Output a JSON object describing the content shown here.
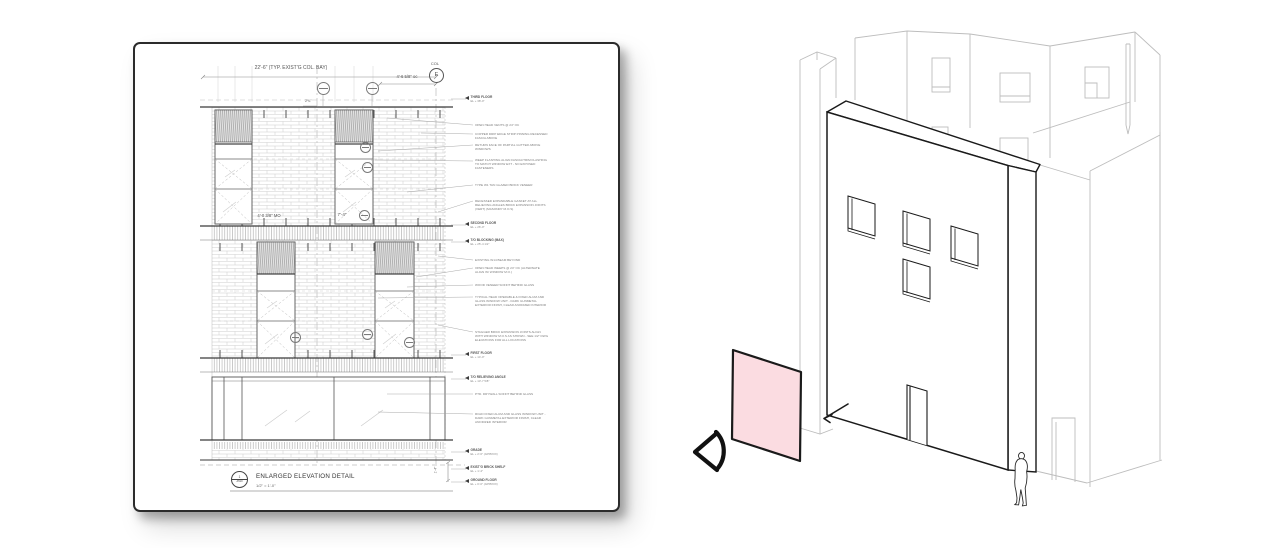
{
  "page": {
    "background": "#ffffff"
  },
  "left_sheet": {
    "title": "ENLARGED ELEVATION DETAIL",
    "scale": "1/2\" = 1'-0\"",
    "title_bubble": {
      "number": "1",
      "sheet": "A510"
    },
    "column_grid": {
      "label_top": "COL",
      "bubble": "E"
    },
    "dimensions": {
      "bay": "22'-6\" (TYP. EXIST'G COL. BAY)",
      "window_spacing": "4'-6 5/8\" oc",
      "offset": "2¾\"",
      "masonry_opening": "4'-0 3/8\" MO",
      "window_width": "7'-4\"",
      "base_height": "1'-4\""
    },
    "markers": [
      {
        "name": "THIRD FLOOR",
        "el": "EL + 38'-0\""
      },
      {
        "name": "SECOND FLOOR",
        "el": "EL + 26'-0\""
      },
      {
        "name": "T/O BLOCKING (MAX)",
        "el": "EL + 25'-4 1/2\""
      },
      {
        "name": "FIRST FLOOR",
        "el": "EL + 14'-0\""
      },
      {
        "name": "T/O RELIEVING ANGLE",
        "el": "EL + 13'-7 5/8\""
      },
      {
        "name": "GRADE",
        "el": "EL + 2'-6\" (APPROX)"
      },
      {
        "name": "EXIST'G BRICK SHELF",
        "el": "EL + 1'-4\""
      },
      {
        "name": "GROUND FLOOR",
        "el": "EL + 0'-0\" (APPROX)"
      }
    ],
    "notes": [
      "OPEN HEAD VENTS @ 24\" OC",
      "COPPER DRIP EDGE STRIP PINNING RECESSED FASCIA ABOVE",
      "RETURN FACE OF PARTIAL GUTTER ABOVE WINDOWS",
      "WEEP FLASHING ALIGN FASCIA/TRIM FLASHING TO MATCH WINDOW EXT - NO EXPOSED FASTENERS",
      "TYPE W1 TAN GLAZED BRICK VENEER",
      "RECESSED EXPANDABLE GASKET AT ALL RELIEVING ANGLES BRICK EXPANSION JOINTS (VERT) (MASONRY M.O.S)",
      "EXISTING W14 BEAM BEYOND",
      "OPEN HEAD WEEPS @ 24\" OC (ALTERNATE ALIGN W/ WINDOW M.O.)",
      "WOOD VENEER SOFFIT BEHIND GLASS",
      "TYPICAL HEAD OPERABLE & FIXED ALUM AND GLASS WINDOW UNIT - DARK GUNMETAL EXTERIOR FINISH, CLEAR ANODIZED INTERIOR",
      "STAGGER BRICK EXPANSION JOINTS ALIGN WITH WINDOW M.O.S AS SHOWN - SEE 1/2\" DWG ELEVATIONS FOR ALL LOCATIONS",
      "PTD. DRYWALL SOFFIT BEHIND GLASS",
      "RIGID FIXED ALUM AND GLASS WINDOW UNIT - DARK GUNMETAL EXTERIOR FINISH, CLEAR ANODIZED INTERIOR"
    ],
    "colors": {
      "paper": "#ffffff",
      "line_dark": "#3a3a3a",
      "line_medium": "#8a8a8a",
      "brick_line": "#c6c6c6"
    }
  },
  "right_view": {
    "colors": {
      "outline": "#1a1a1a",
      "background_line": "#bdbdbd",
      "panel_fill": "#fbdce1"
    },
    "icons": [
      "view-direction-eye-icon",
      "leader-arrow-icon",
      "human-scale-figure"
    ]
  }
}
